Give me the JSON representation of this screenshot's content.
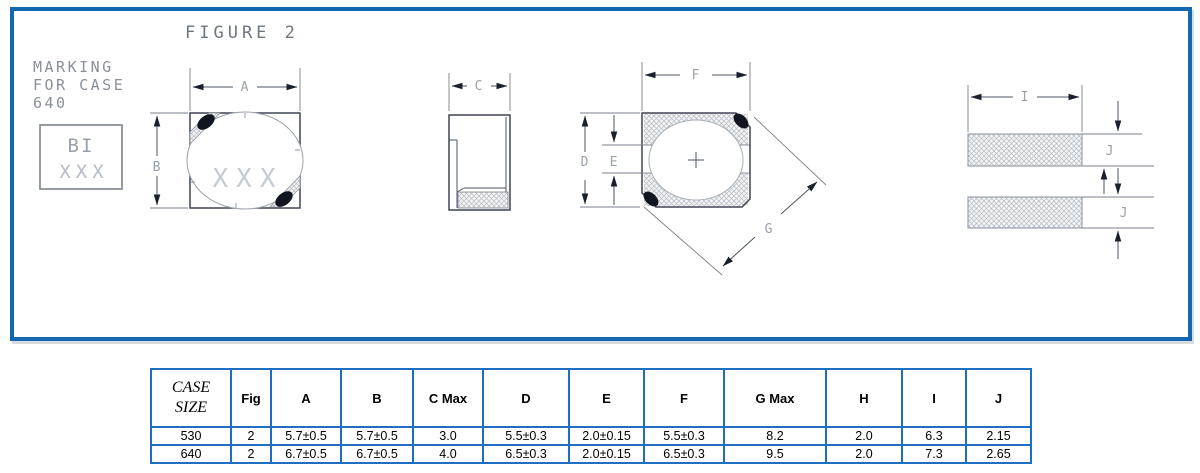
{
  "colors": {
    "panel_border_blue": "#1267ae",
    "table_border_blue": "#1e6fc1",
    "drawing_line": "#3d4450",
    "dimension_gray": "#9aa1ab",
    "hatch_gray": "#b6bcc3"
  },
  "drawing": {
    "figure_title": "FIGURE 2",
    "marking_note": [
      "MARKING",
      "FOR CASE",
      "640"
    ],
    "marking_box": {
      "line1": "BI",
      "line2": "XXX"
    },
    "top_view_marking": "XXX",
    "dims": {
      "a": "A",
      "b": "B",
      "c": "C",
      "d": "D",
      "e": "E",
      "f": "F",
      "g": "G",
      "i": "I",
      "j": "J"
    }
  },
  "table": {
    "headers": [
      "CASE SIZE",
      "Fig",
      "A",
      "B",
      "C Max",
      "D",
      "E",
      "F",
      "G Max",
      "H",
      "I",
      "J"
    ],
    "rows": [
      [
        "530",
        "2",
        "5.7±0.5",
        "5.7±0.5",
        "3.0",
        "5.5±0.3",
        "2.0±0.15",
        "5.5±0.3",
        "8.2",
        "2.0",
        "6.3",
        "2.15"
      ],
      [
        "640",
        "2",
        "6.7±0.5",
        "6.7±0.5",
        "4.0",
        "6.5±0.3",
        "2.0±0.15",
        "6.5±0.3",
        "9.5",
        "2.0",
        "7.3",
        "2.65"
      ]
    ]
  }
}
